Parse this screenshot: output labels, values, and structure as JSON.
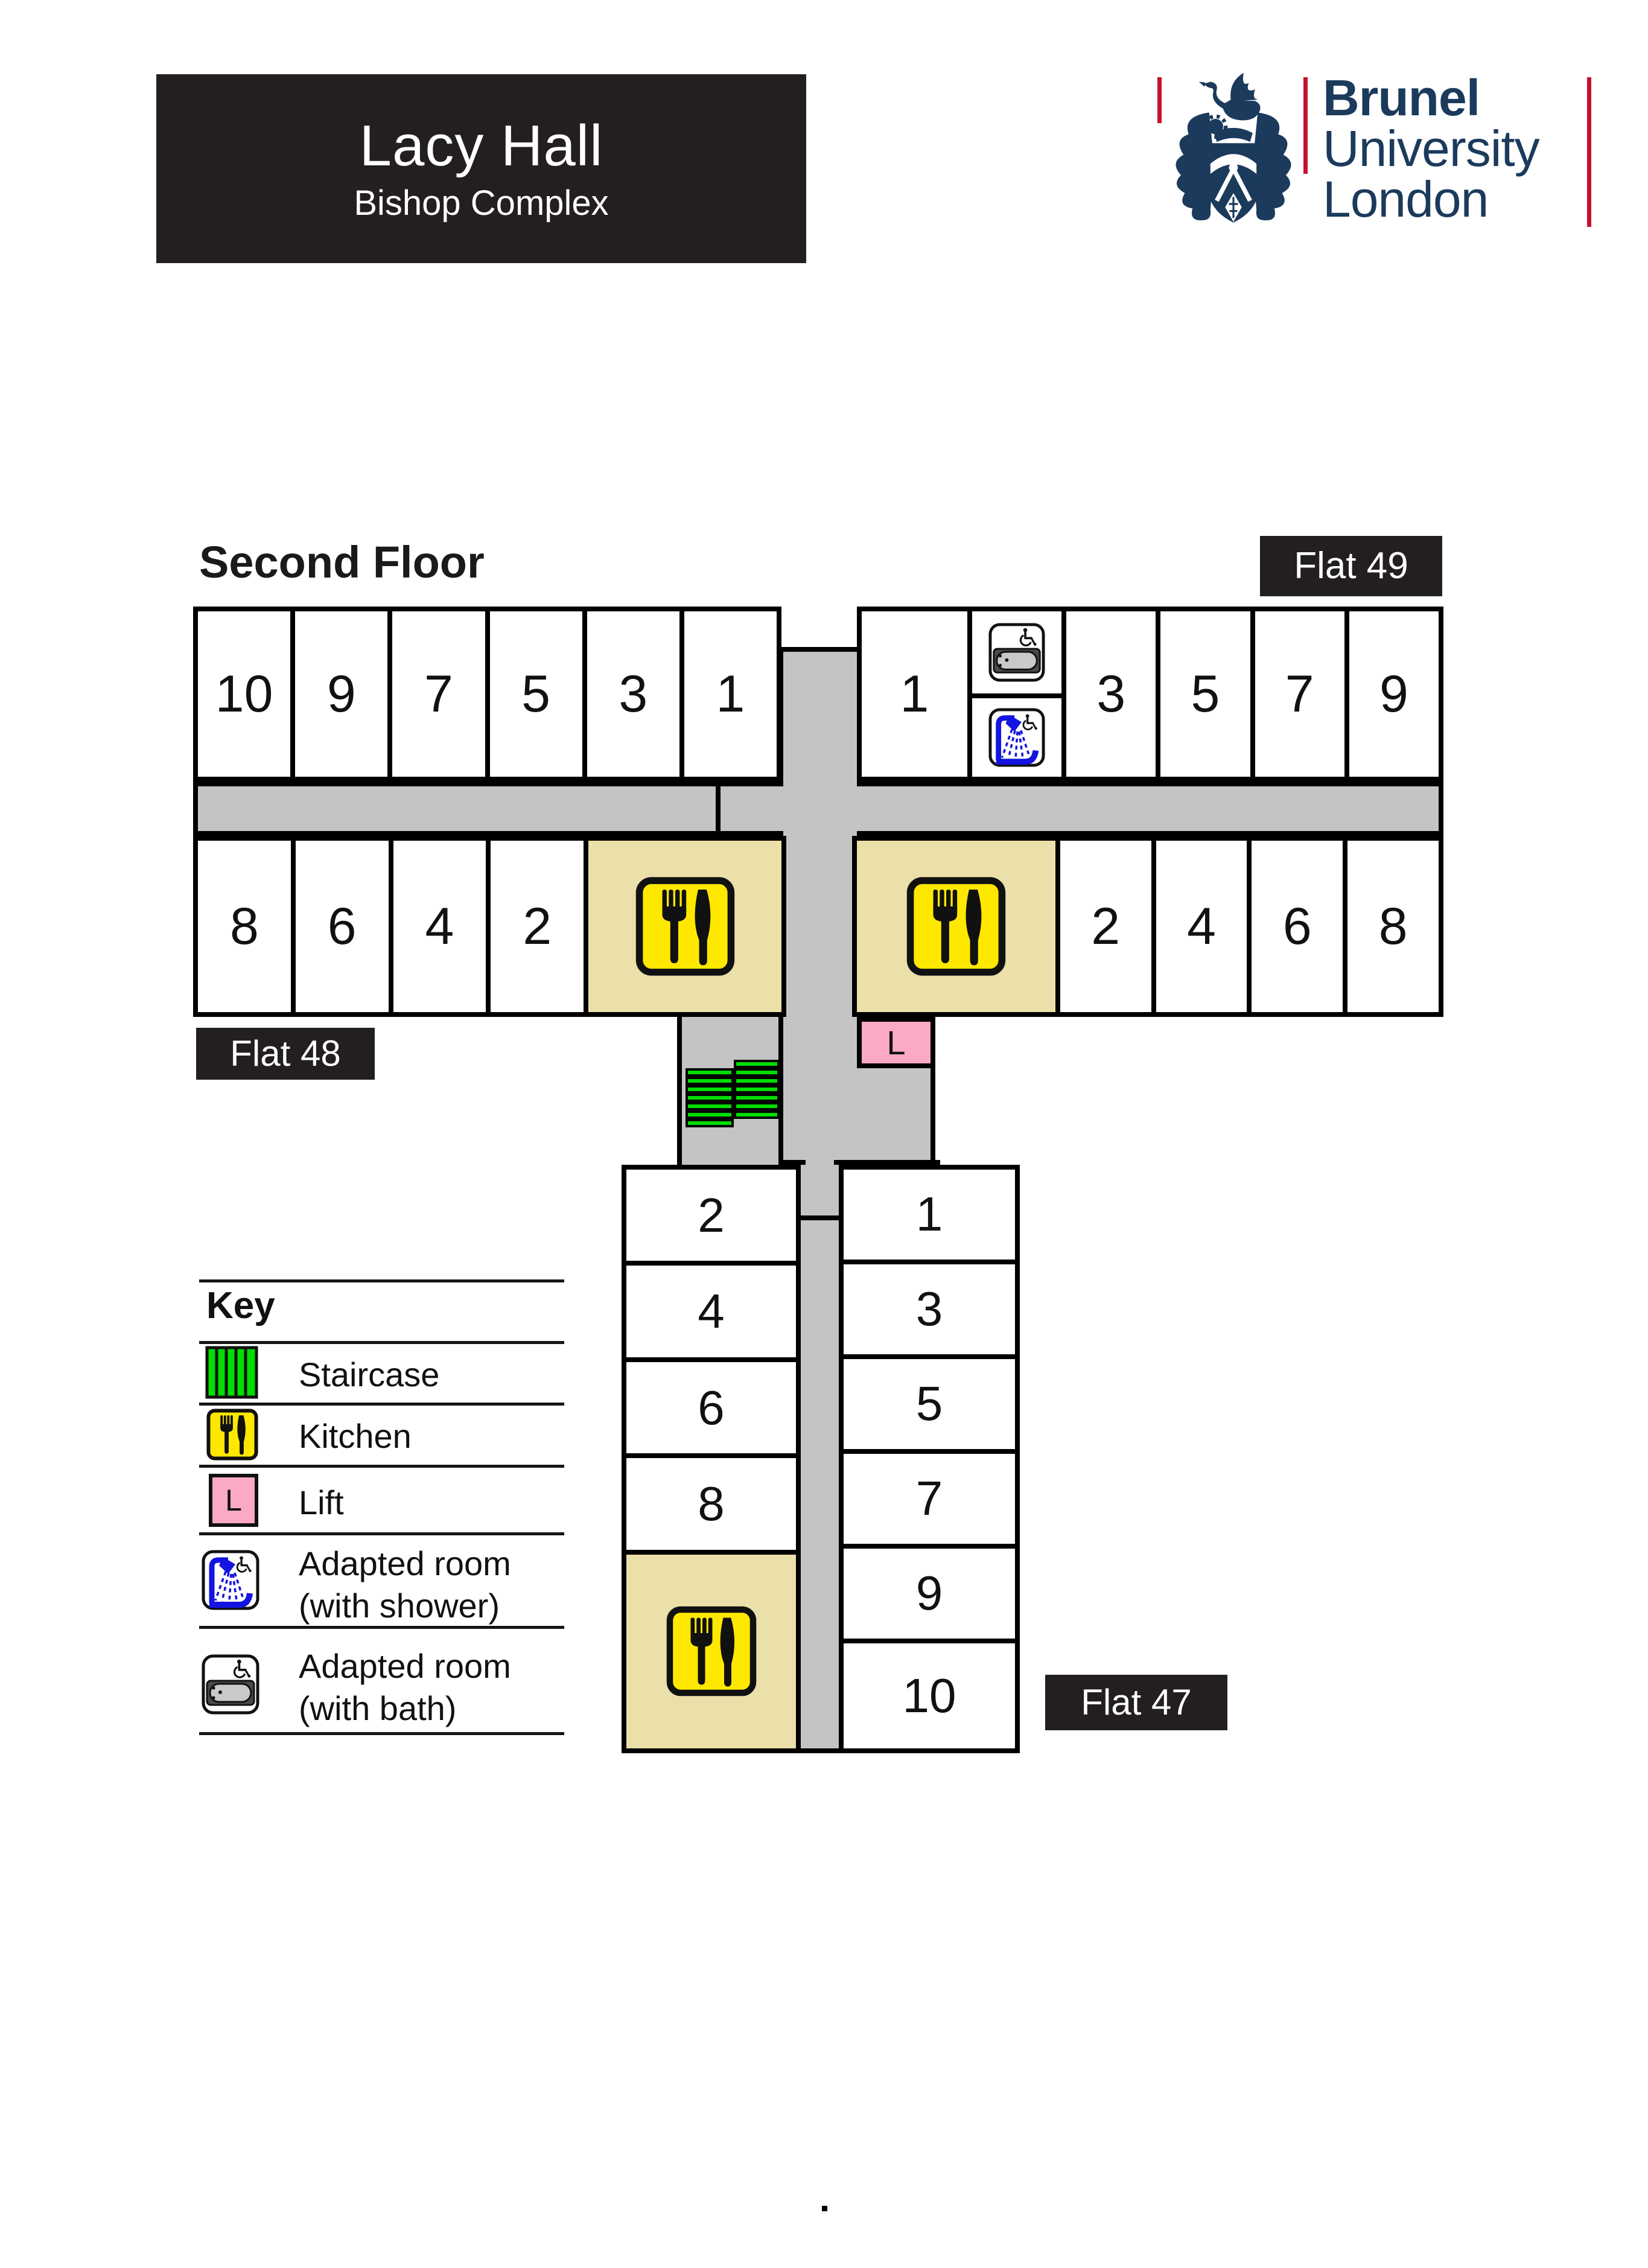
{
  "title_block": {
    "title": "Lacy Hall",
    "subtitle": "Bishop Complex"
  },
  "logo": {
    "name": "Brunel",
    "line2": "University",
    "line3": "London"
  },
  "floor_title": "Second Floor",
  "flat_labels": {
    "flat49": "Flat 49",
    "flat48": "Flat 48",
    "flat47": "Flat 47"
  },
  "wing_left": {
    "top_rooms": [
      "10",
      "9",
      "7",
      "5",
      "3",
      "1"
    ],
    "bottom_rooms": [
      "8",
      "6",
      "4",
      "2"
    ]
  },
  "wing_right": {
    "first_top_room": "1",
    "top_rooms": [
      "3",
      "5",
      "7",
      "9"
    ],
    "bottom_rooms": [
      "2",
      "4",
      "6",
      "8"
    ]
  },
  "wing_lower": {
    "left_rooms": [
      "2",
      "4",
      "6",
      "8"
    ],
    "right_rooms": [
      "1",
      "3",
      "5",
      "7",
      "9",
      "10"
    ]
  },
  "lift_letter": "L",
  "key": {
    "heading": "Key",
    "staircase": "Staircase",
    "kitchen": "Kitchen",
    "lift": "Lift",
    "adapted_shower_line1": "Adapted room",
    "adapted_shower_line2": "(with shower)",
    "adapted_bath_line1": "Adapted room",
    "adapted_bath_line2": "(with bath)"
  },
  "footer_mark": ".",
  "icons": {
    "crest": "brunel-crest-icon",
    "staircase": "green-striped-stairs-icon",
    "kitchen": "fork-knife-icon",
    "lift": "lift-L-square",
    "adapted_shower": "wheelchair-shower-icon",
    "adapted_bath": "wheelchair-bath-icon"
  },
  "colors": {
    "navy": "#1b3a5c",
    "red": "#c8102e",
    "corridor": "#c4c4c4",
    "kitchen_area": "#ebdfaa",
    "kitchen_icon": "#ffe800",
    "staircase": "#00dd00",
    "lift": "#fba9c5",
    "label_bg": "#231f20"
  }
}
